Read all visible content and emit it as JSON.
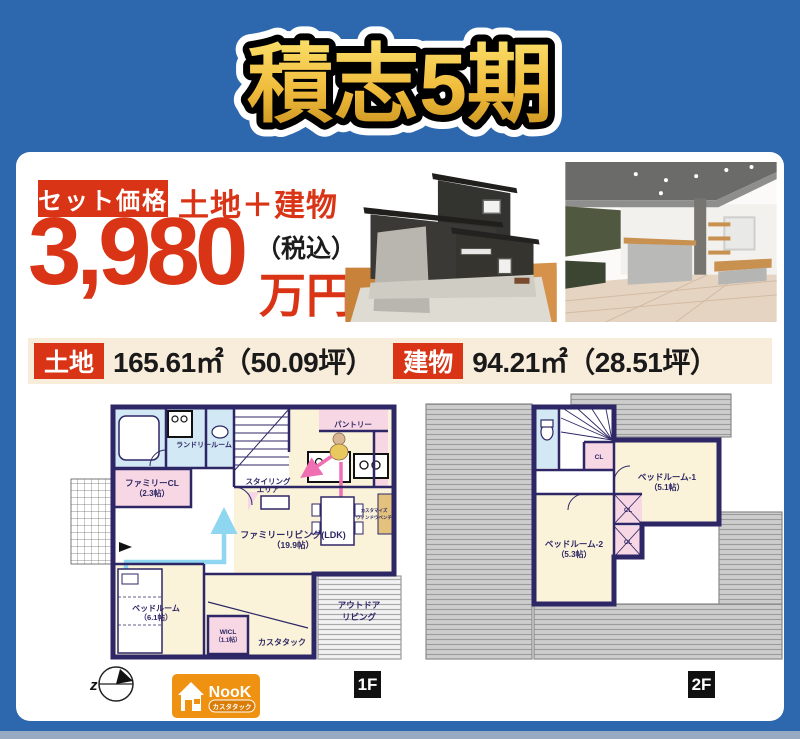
{
  "page": {
    "background_color": "#2d68ae",
    "card_color": "#ffffff",
    "footer_strip_color": "#98a9c2"
  },
  "title": {
    "text": "積志5期",
    "gold_top": "#fbe06b",
    "gold_bottom": "#c9921f"
  },
  "price": {
    "badge_label": "セット価格",
    "combo_label": "土地＋建物",
    "amount": "3,980",
    "tax_label": "（税込）",
    "unit_label": "万円",
    "accent_color": "#d93415"
  },
  "area_bar": {
    "background_color": "#f8ecdb",
    "land_label": "土地",
    "land_value": "165.61㎡（50.09坪）",
    "building_label": "建物",
    "building_value": "94.21㎡（28.51坪）"
  },
  "plan_1f": {
    "badge": "1F",
    "laundry": "ランドリールーム",
    "family_cl": "ファミリーCL",
    "family_cl_size": "（2.3帖）",
    "pantry": "パントリー",
    "styling_line1": "スタイリング",
    "styling_line2": "エリア",
    "ldk": "ファミリーリビング(LDK)",
    "ldk_size": "（19.9帖）",
    "bedroom": "ベッドルーム",
    "bedroom_size": "（6.1帖）",
    "wicl": "WICL",
    "wicl_size": "（1.1帖）",
    "custom_tuck": "カスタタック",
    "outdoor_line1": "アウトドア",
    "outdoor_line2": "リビング",
    "bench_line1": "カスタマイズ",
    "bench_line2": "ウィンドウベンチ"
  },
  "plan_2f": {
    "badge": "2F",
    "closet": "CL",
    "bedroom1": "ベッドルーム-1",
    "bedroom1_size": "（5.1帖）",
    "bedroom2": "ベッドルーム-2",
    "bedroom2_size": "（5.3帖）"
  },
  "compass": {
    "letter": "z"
  },
  "logo": {
    "brand": "NooK",
    "tagline": "カスタタック",
    "color": "#ef9211"
  }
}
